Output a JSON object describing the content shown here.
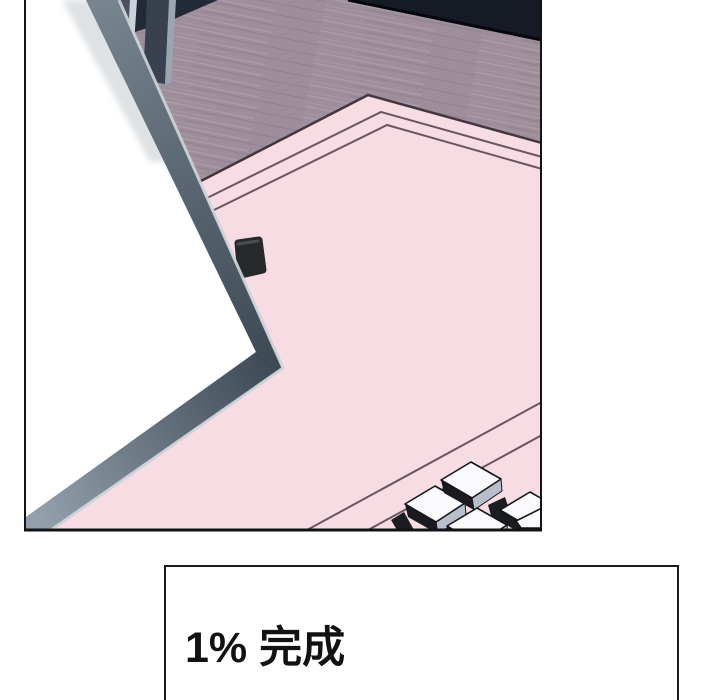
{
  "viewer": {
    "page_background": "#ffffff"
  },
  "comic_panel": {
    "scene_elements": [
      "wood-floor",
      "navy-wall-shadow",
      "chair-legs",
      "door-edge",
      "light-wedge",
      "pink-carpet",
      "carpet-border-lines",
      "fallen-phone",
      "piano-keys"
    ]
  },
  "loading": {
    "text": "1% 完成",
    "percent_complete": 1
  },
  "palette": {
    "page_bg": "#ffffff",
    "floor": "#9d8e9a",
    "floor_streak_light": "#b8aab5",
    "floor_streak_dark": "#837384",
    "navy": "#161a24",
    "navy_edge": "#05070c",
    "furniture": "#222937",
    "pink": "#f7dde3",
    "carpet_line": "#6a5560",
    "carpet_outline": "#44363f",
    "band_edge": "#ccd2d8",
    "phone": "#26282b",
    "key_top": "#fafafc",
    "key_side": "#b9bfca",
    "key_front": "#191b20",
    "panel_border": "#121316",
    "box_border": "#1c1c1c",
    "text_color": "#121212"
  }
}
